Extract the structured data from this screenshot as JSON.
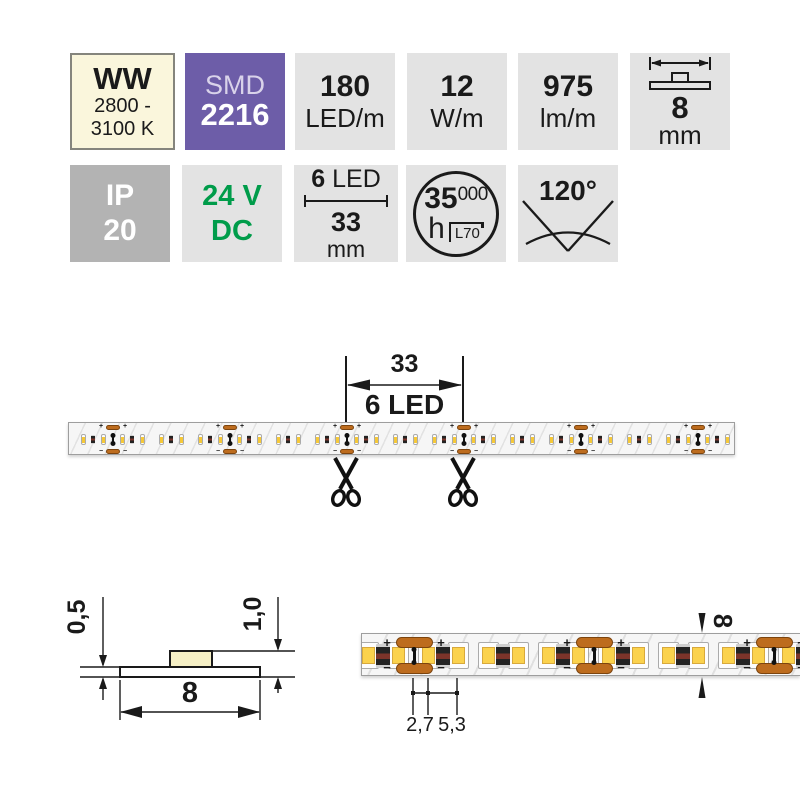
{
  "colors": {
    "accent_purple": "#6d5da8",
    "accent_green": "#009c4a",
    "cream": "#faf6dc",
    "badge_gray": "#e3e3e3",
    "badge_gray_dark": "#b3b3b3",
    "pad_copper": "#bd6c1e",
    "led_yellow": "#fbd24d"
  },
  "badges": {
    "color_temp": {
      "code": "WW",
      "range_line1": "2800 -",
      "range_line2": "3100 K"
    },
    "chip": {
      "type": "SMD",
      "size": "2216"
    },
    "led_density": {
      "value": "180",
      "unit": "LED/m"
    },
    "power": {
      "value": "12",
      "unit": "W/m"
    },
    "flux": {
      "value": "975",
      "unit": "lm/m"
    },
    "strip_width": {
      "value": "8",
      "unit": "mm"
    },
    "ip_rating": {
      "code": "IP",
      "value": "20"
    },
    "voltage": {
      "value": "24 V",
      "type": "DC"
    },
    "cut_unit": {
      "led_count": "6",
      "led_label": "LED",
      "length": "33",
      "unit": "mm"
    },
    "lifetime": {
      "value_big": "35",
      "value_small": "000",
      "unit": "h",
      "standard": "L70"
    },
    "beam_angle": {
      "value": "120°"
    }
  },
  "strip_diagram": {
    "dim_length": "33",
    "dim_leds": "6 LED",
    "plus": "+",
    "minus": "−"
  },
  "cross_section": {
    "pcb_height": "0,5",
    "total_height": "1,0",
    "width": "8"
  },
  "closeup": {
    "dim_small": "2,7",
    "dim_large": "5,3",
    "width": "8",
    "plus": "+",
    "minus": "−"
  }
}
